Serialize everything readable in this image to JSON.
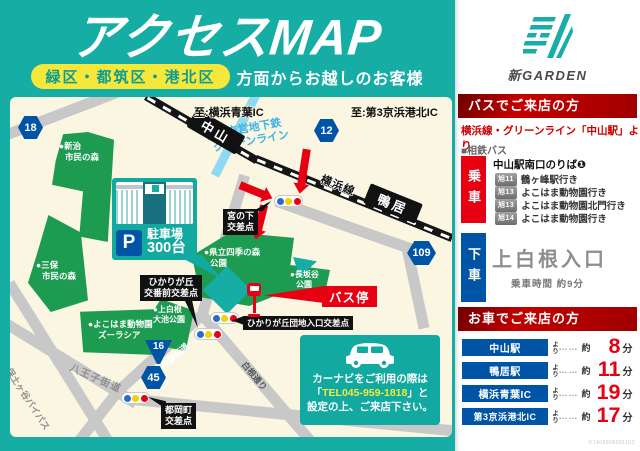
{
  "colors": {
    "teal": "#16ADA5",
    "yellow": "#F5E83B",
    "red": "#E60012",
    "blue": "#0054A6",
    "dark_red": "#A80000",
    "map_bg": "#FBF6E2",
    "park_green": "#1C9B51",
    "road_gray": "#C8C8C8"
  },
  "header": {
    "title": "アクセスMAP",
    "area_pill": "緑区・都筑区・港北区",
    "subtitle": "方面からお越しのお客様"
  },
  "brand": "新GARDEN",
  "map": {
    "dest_top_left": "至:横浜青葉IC",
    "dest_top_right": "至:第3京浜港北IC",
    "subway_line1": "横浜市営地下鉄",
    "subway_line2": "グリーンライン",
    "station_nakayama": "中山",
    "station_kamoi": "鴨居",
    "rail_label": "横浜線",
    "badges": {
      "b18": "18",
      "b12": "12",
      "b16": "16",
      "b45": "45",
      "b109": "109"
    },
    "parks": {
      "niiharu": [
        "●新治",
        "市民の森"
      ],
      "miho": [
        "●三保",
        "市民の森"
      ],
      "shiki": [
        "●県立四季の森",
        "公園"
      ],
      "nagasakaya": [
        "●長坂谷",
        "公園"
      ],
      "zoorasia": [
        "●よこはま動物園",
        "ズーラシア"
      ],
      "oike": [
        "●上白根",
        "大池公園"
      ]
    },
    "intersections": {
      "miyanoshita": [
        "宮の下",
        "交差点"
      ],
      "kobanmae": [
        "ひかりが丘",
        "交番前交差点"
      ],
      "danchi": "ひかりが丘団地入口交差点",
      "tsuoka": [
        "都岡町",
        "交差点"
      ]
    },
    "roads": {
      "hachioji": "八王子街道",
      "hodogaya": "保土ヶ谷バイパス",
      "nakahara": "中原街道",
      "shirane": "白根通り"
    },
    "bus_stop": "バス停",
    "parking": {
      "p": "P",
      "label": "駐車場",
      "count": "300台"
    },
    "navi": {
      "line1": "カーナビをご利用の際は",
      "tel_open": "「",
      "tel": "TEL045-959-1818",
      "tel_close": "」と",
      "line3": "設定の上、ご来店下さい。"
    }
  },
  "bus_section": {
    "title": "バスでご来店の方",
    "subtitle": "横浜線・グリーンライン「中山駅」より",
    "company": "■相鉄バス",
    "board_label": "乗車",
    "board_stop": "中山駅南口のりば❶",
    "routes": [
      {
        "badge": "旭11",
        "dest": "鶴ヶ峰駅行き"
      },
      {
        "badge": "旭13",
        "dest": "よこはま動物園行き"
      },
      {
        "badge": "旭13",
        "dest": "よこはま動物園北門行き"
      },
      {
        "badge": "旭14",
        "dest": "よこはま動物園行き"
      }
    ],
    "alight_label": "下車",
    "alight_stop": "上白根入口",
    "ride_time": "乗車時間 約9分"
  },
  "car_section": {
    "title": "お車でご来店の方",
    "yori": "より",
    "dots": "……",
    "approx": "約",
    "unit": "分",
    "rows": [
      {
        "from": "中山駅",
        "minutes": "8"
      },
      {
        "from": "鴨居駅",
        "minutes": "11"
      },
      {
        "from": "横浜青葉IC",
        "minutes": "19"
      },
      {
        "from": "第3京浜港北IC",
        "minutes": "17"
      }
    ]
  },
  "footer_code": "©1409808081103"
}
